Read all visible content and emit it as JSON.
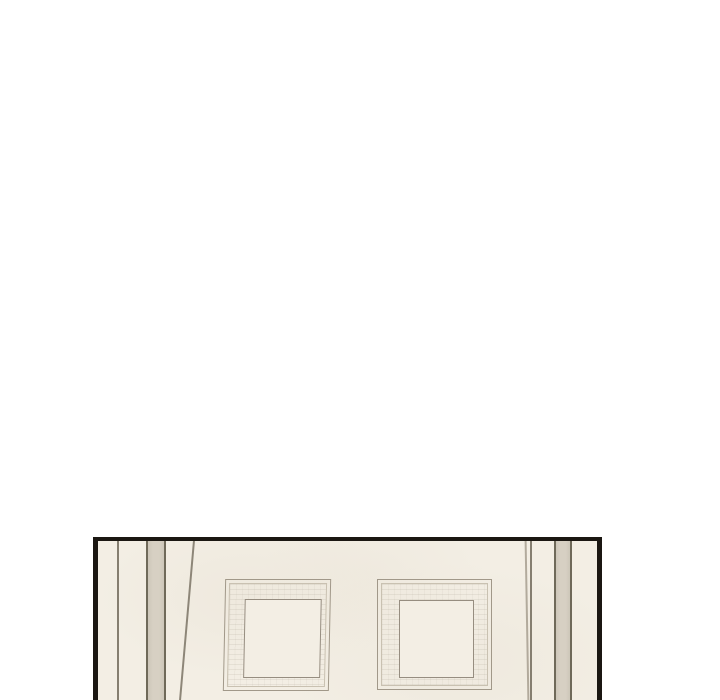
{
  "scene": {
    "type": "webtoon-comic-panel",
    "description": "Mostly blank white webtoon page; at the bottom a partially visible comic panel shows a cream-colored paneled wall or double door with two recessed square panels and vertical beige molding stripes near each edge, framed by a black panel border cut off by the bottom of the image.",
    "visible_text": ""
  },
  "colors": {
    "page-bg": "#ffffff",
    "ink": "#1b1712",
    "wall": "#f3eee4",
    "stripe": "#d7d0c3",
    "line-dark": "#6f6959",
    "line-mid": "#857e70",
    "line-door": "#8d8678",
    "line-faint": "#b2aa9c",
    "frame-line": "#a19889",
    "frame-line-light": "#c9c1b1",
    "frame-inner-line": "#968d80"
  }
}
